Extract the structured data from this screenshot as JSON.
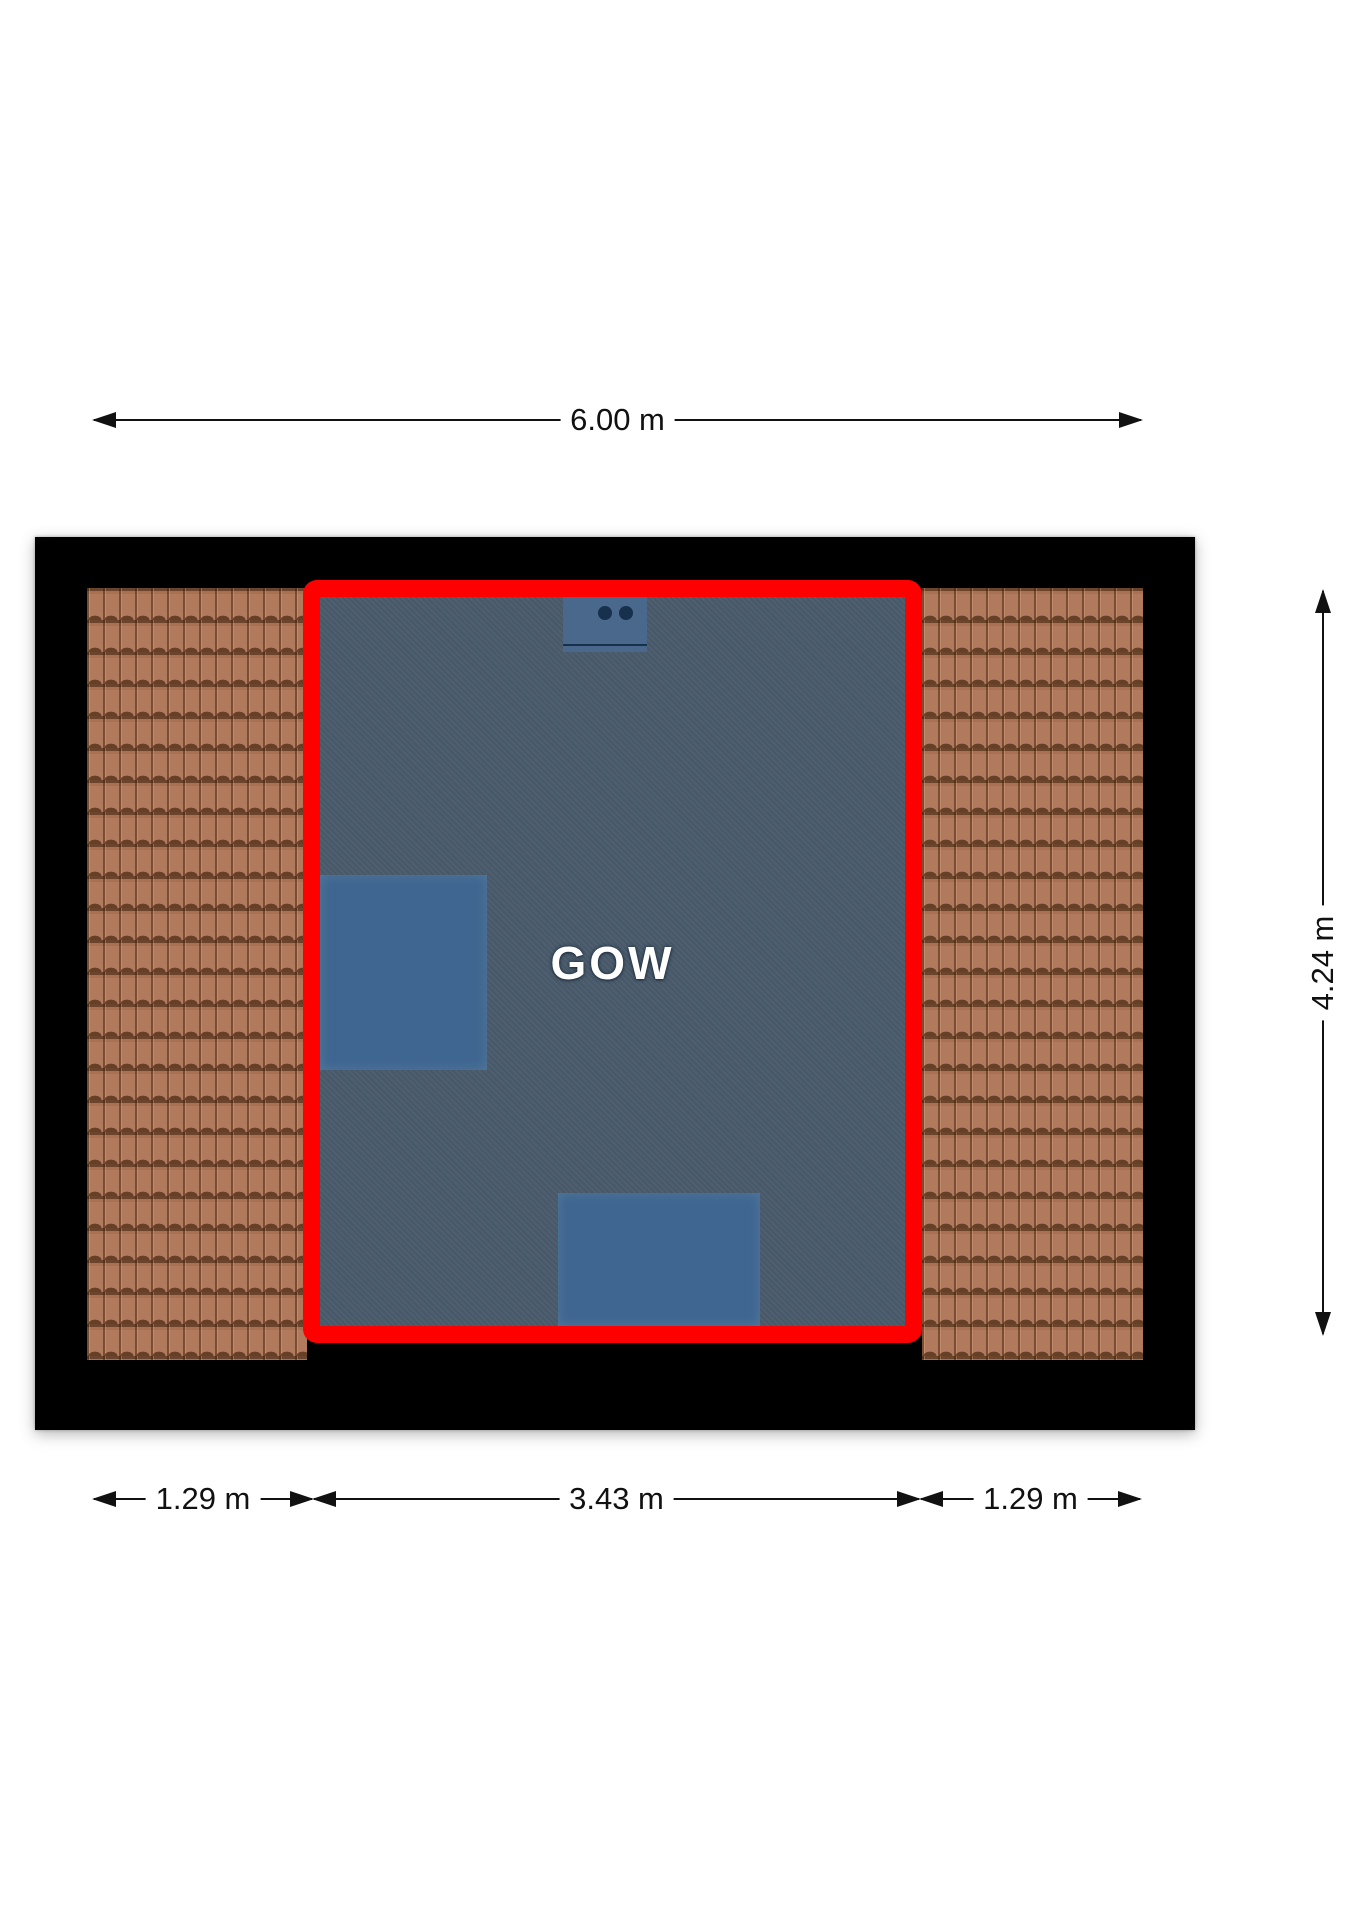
{
  "room": {
    "label": "GOW"
  },
  "dimensions": {
    "top": {
      "label": "6.00 m",
      "value_m": 6.0
    },
    "right": {
      "label": "4.24 m",
      "value_m": 4.24
    },
    "bottom_left": {
      "label": "1.29 m",
      "value_m": 1.29
    },
    "bottom_middle": {
      "label": "3.43 m",
      "value_m": 3.43
    },
    "bottom_right": {
      "label": "1.29 m",
      "value_m": 1.29
    }
  },
  "colors": {
    "outline_red": "#fe0000",
    "room_fill": "#4a5b6c",
    "furniture_blue": "#3e6690",
    "appliance_blue": "#49688c",
    "knob_navy": "#16304e",
    "tile_base": "#b17a5c",
    "frame_black": "#000000",
    "dim_ink": "#111111",
    "room_label_white": "#ffffff"
  }
}
